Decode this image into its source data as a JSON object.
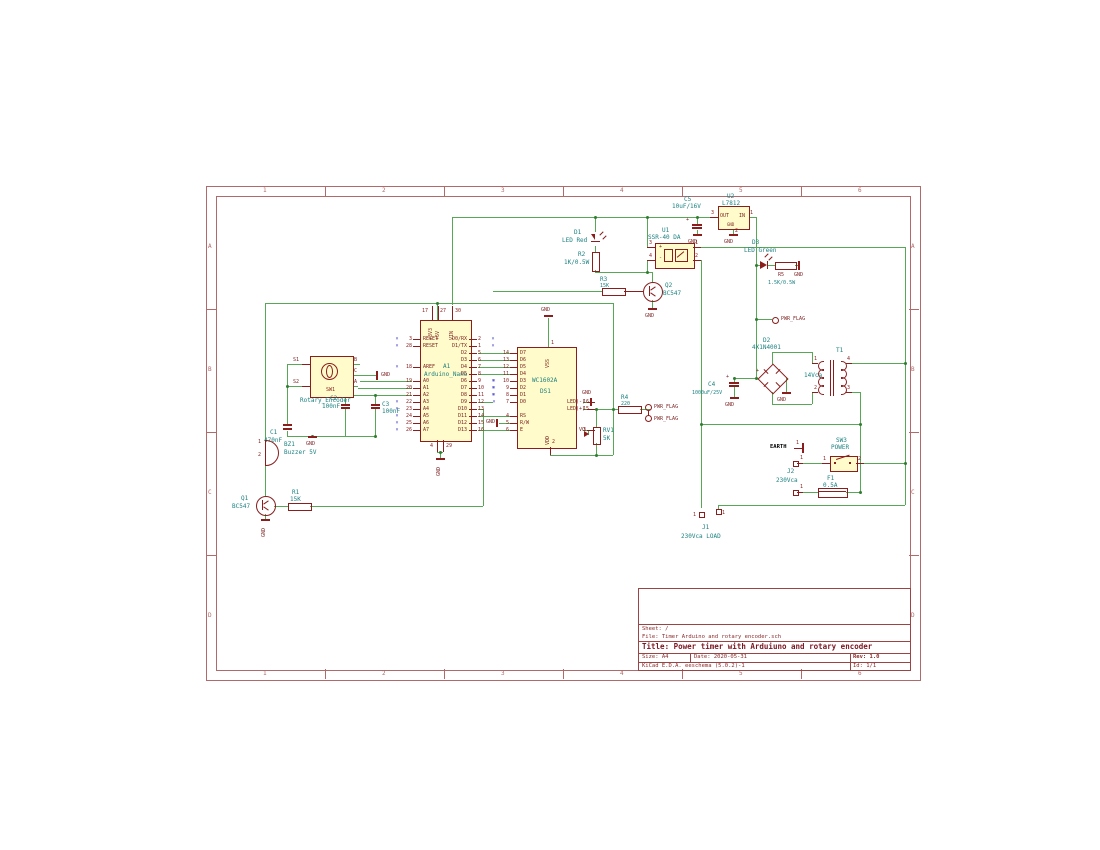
{
  "colors": {
    "wire": "#57a757",
    "symbol": "#8b1d1d",
    "field": "#1d8181",
    "frame": "#b06a6a",
    "fill": "#fffbca",
    "noconnect": "#3c3cc8"
  },
  "frame": {
    "columns": [
      "1",
      "2",
      "3",
      "4",
      "5",
      "6"
    ],
    "rows": [
      "A",
      "B",
      "C",
      "D"
    ]
  },
  "title_block": {
    "sheet": "Sheet: /",
    "file": "File: Timer Arduino and rotary encoder.sch",
    "title": "Title: Power timer with Arduiuno and rotary encoder",
    "size": "Size: A4",
    "date": "Date: 2020-05-31",
    "rev": "Rev: 1.0",
    "tool": "KiCad E.D.A.  eeschema (5.0.2)-1",
    "id": "Id: 1/1"
  },
  "labels": {
    "gnd": "GND",
    "earth": "EARTH",
    "pwr_flag": "PWR_FLAG",
    "plus": "+",
    "minus": "-"
  },
  "arduino": {
    "ref": "A1",
    "value": "Arduino_Nano",
    "top_pins": [
      {
        "num": "17",
        "name": "+3V3"
      },
      {
        "num": "27",
        "name": "+5V"
      },
      {
        "num": "30",
        "name": "VIN"
      }
    ],
    "bottom_pins": [
      {
        "num": "4",
        "name": "GND"
      },
      {
        "num": "29",
        "name": "GND"
      }
    ],
    "left_pins": [
      {
        "nc": "×",
        "num": "3",
        "name": "RESET"
      },
      {
        "nc": "×",
        "num": "28",
        "name": "RESET"
      },
      {},
      {},
      {
        "nc": "×",
        "num": "18",
        "name": "AREF"
      },
      {},
      {
        "num": "19",
        "name": "A0"
      },
      {
        "num": "20",
        "name": "A1"
      },
      {
        "num": "21",
        "name": "A2"
      },
      {
        "nc": "×",
        "num": "22",
        "name": "A3"
      },
      {
        "nc": "×",
        "num": "23",
        "name": "A4"
      },
      {
        "nc": "×",
        "num": "24",
        "name": "A5"
      },
      {
        "nc": "×",
        "num": "25",
        "name": "A6"
      },
      {
        "nc": "×",
        "num": "26",
        "name": "A7"
      }
    ],
    "right_pins": [
      {
        "nc": "×",
        "num": "2",
        "name": "D0/RX"
      },
      {
        "nc": "×",
        "num": "1",
        "name": "D1/TX"
      },
      {
        "num": "5",
        "name": "D2"
      },
      {
        "num": "6",
        "name": "D3"
      },
      {
        "num": "7",
        "name": "D4"
      },
      {
        "num": "8",
        "name": "D5"
      },
      {
        "nc": "×",
        "num": "9",
        "name": "D6"
      },
      {
        "nc": "×",
        "num": "10",
        "name": "D7"
      },
      {
        "nc": "×",
        "num": "11",
        "name": "D8"
      },
      {
        "num": "12",
        "name": "D9"
      },
      {
        "num": "13",
        "name": "D10"
      },
      {
        "num": "14",
        "name": "D11"
      },
      {
        "num": "15",
        "name": "D12"
      },
      {
        "num": "16",
        "name": "D13"
      }
    ]
  },
  "lcd": {
    "ref": "DS1",
    "value": "WC1602A",
    "top_pin": {
      "num": "1",
      "name": "VSS"
    },
    "bottom_pin": {
      "num": "2",
      "name": "VDD"
    },
    "left_pins": [
      {
        "num": "14",
        "name": "D7"
      },
      {
        "num": "13",
        "name": "D6"
      },
      {
        "num": "12",
        "name": "D5"
      },
      {
        "num": "11",
        "name": "D4"
      },
      {
        "nc": "×",
        "num": "10",
        "name": "D3"
      },
      {
        "nc": "×",
        "num": "9",
        "name": "D2"
      },
      {
        "nc": "×",
        "num": "8",
        "name": "D1"
      },
      {
        "nc": "×",
        "num": "7",
        "name": "D0"
      },
      {},
      {
        "num": "4",
        "name": "RS"
      },
      {
        "num": "5",
        "name": "R/W"
      },
      {
        "num": "6",
        "name": "E"
      }
    ],
    "right_pins": [
      {
        "num": "16",
        "name": "LED(-)"
      },
      {
        "num": "15",
        "name": "LED(+)"
      },
      {
        "num": "3",
        "name": "VO"
      }
    ]
  },
  "encoder": {
    "ref": "SW1",
    "value": "Rotary_Encoder",
    "left_pins": [
      "S1",
      "S2"
    ],
    "right_pins": [
      "B",
      "C",
      "A"
    ]
  },
  "parts": {
    "c1": {
      "ref": "C1",
      "value": "470nF"
    },
    "c2": {
      "ref": "C2",
      "value": "100nF"
    },
    "c3": {
      "ref": "C3",
      "value": "100nF"
    },
    "c4": {
      "ref": "C4",
      "value": "1000uF/25V"
    },
    "c5": {
      "ref": "C5",
      "value": "10uF/16V"
    },
    "r1": {
      "ref": "R1",
      "value": "15K"
    },
    "r2": {
      "ref": "R2",
      "value": "1K/0.5W"
    },
    "r3": {
      "ref": "R3",
      "value": "15K"
    },
    "r4": {
      "ref": "R4",
      "value": "220"
    },
    "r5": {
      "ref": "R5",
      "value": "1.5K/0.5W"
    },
    "rv1": {
      "ref": "RV1",
      "value": "5K"
    },
    "d1": {
      "ref": "D1",
      "value": "LED Red"
    },
    "d2": {
      "ref": "D2",
      "value": "4X1N4001"
    },
    "d3": {
      "ref": "D3",
      "value": "LED Green"
    },
    "q1": {
      "ref": "Q1",
      "value": "BC547"
    },
    "q2": {
      "ref": "Q2",
      "value": "BC547"
    },
    "u1": {
      "ref": "U1",
      "value": "SSR-40 DA",
      "pins": [
        "3",
        "4",
        "1",
        "2"
      ]
    },
    "u2": {
      "ref": "U2",
      "value": "L7812",
      "pin_names": [
        "OUT",
        "IN",
        "GND"
      ],
      "pins": [
        "3",
        "1",
        "2"
      ]
    },
    "t1": {
      "ref": "T1",
      "value": "14Vca",
      "pins": [
        "1",
        "2",
        "4",
        "3"
      ]
    },
    "bz1": {
      "ref": "BZ1",
      "value": "Buzzer 5V",
      "pins": [
        "1",
        "2"
      ]
    },
    "f1": {
      "ref": "F1",
      "value": "0.5A"
    },
    "sw3": {
      "ref": "SW3",
      "value": "POWER",
      "pins": [
        "1",
        "2"
      ]
    },
    "j1": {
      "ref": "J1",
      "value": "230Vca LOAD",
      "pins": [
        "1",
        "1"
      ]
    },
    "j2": {
      "ref": "J2",
      "value": "230Vca",
      "pins": [
        "1",
        "1"
      ]
    },
    "earth": {
      "pin": "1"
    }
  }
}
